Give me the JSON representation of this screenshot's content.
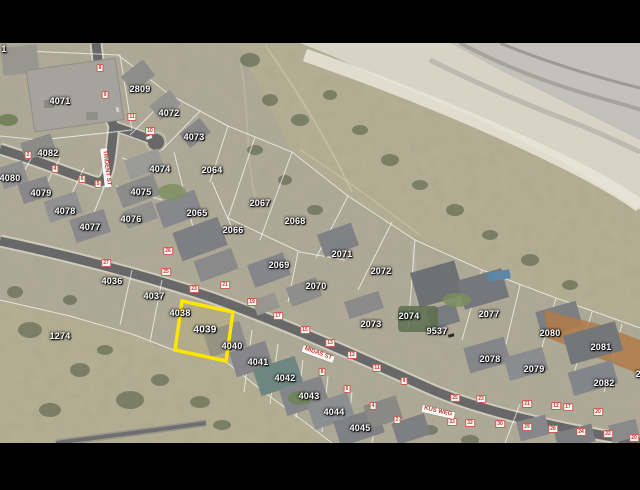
{
  "map": {
    "highlighted_parcel": "4039",
    "colors": {
      "highlight_outline": "#ffe600",
      "parcel_label_text": "#ffffff",
      "road_marker_text": "#c0392b",
      "road": "#686868",
      "dune_sand": "#b6ae94",
      "beach_sand": "#d7d3c5"
    },
    "street_labels": [
      {
        "text": "TRIDENT ST",
        "x": 106,
        "y": 168,
        "rot": 83
      },
      {
        "text": "MIDAS ST",
        "x": 318,
        "y": 354,
        "rot": 20
      },
      {
        "text": "KUS WEG",
        "x": 438,
        "y": 412,
        "rot": 13
      }
    ],
    "parcel_labels": [
      {
        "id": "1",
        "x": 4,
        "y": 49
      },
      {
        "id": "4071",
        "x": 60,
        "y": 101
      },
      {
        "id": "2809",
        "x": 140,
        "y": 89
      },
      {
        "id": "4072",
        "x": 169,
        "y": 113
      },
      {
        "id": "4073",
        "x": 194,
        "y": 137
      },
      {
        "id": "2064",
        "x": 212,
        "y": 170
      },
      {
        "id": "4074",
        "x": 160,
        "y": 169
      },
      {
        "id": "4075",
        "x": 141,
        "y": 192
      },
      {
        "id": "4076",
        "x": 131,
        "y": 219
      },
      {
        "id": "4082",
        "x": 48,
        "y": 153
      },
      {
        "id": "4080",
        "x": 10,
        "y": 178
      },
      {
        "id": "4079",
        "x": 41,
        "y": 193
      },
      {
        "id": "4078",
        "x": 65,
        "y": 211
      },
      {
        "id": "4077",
        "x": 90,
        "y": 227
      },
      {
        "id": "2065",
        "x": 197,
        "y": 213
      },
      {
        "id": "2066",
        "x": 233,
        "y": 230
      },
      {
        "id": "2067",
        "x": 260,
        "y": 203
      },
      {
        "id": "2068",
        "x": 295,
        "y": 221
      },
      {
        "id": "2069",
        "x": 279,
        "y": 265
      },
      {
        "id": "2070",
        "x": 316,
        "y": 286
      },
      {
        "id": "2071",
        "x": 342,
        "y": 254
      },
      {
        "id": "2072",
        "x": 381,
        "y": 271
      },
      {
        "id": "2073",
        "x": 371,
        "y": 324
      },
      {
        "id": "2074",
        "x": 409,
        "y": 316
      },
      {
        "id": "9537",
        "x": 437,
        "y": 331
      },
      {
        "id": "2077",
        "x": 489,
        "y": 314
      },
      {
        "id": "2078",
        "x": 490,
        "y": 359
      },
      {
        "id": "2079",
        "x": 534,
        "y": 369
      },
      {
        "id": "2080",
        "x": 550,
        "y": 333
      },
      {
        "id": "2081",
        "x": 601,
        "y": 347
      },
      {
        "id": "2082",
        "x": 604,
        "y": 383
      },
      {
        "id": "2083",
        "x": 646,
        "y": 374
      },
      {
        "id": "4036",
        "x": 112,
        "y": 281
      },
      {
        "id": "4037",
        "x": 154,
        "y": 296
      },
      {
        "id": "4038",
        "x": 180,
        "y": 313
      },
      {
        "id": "4039",
        "x": 205,
        "y": 330
      },
      {
        "id": "4040",
        "x": 232,
        "y": 346
      },
      {
        "id": "4041",
        "x": 258,
        "y": 362
      },
      {
        "id": "4042",
        "x": 285,
        "y": 378
      },
      {
        "id": "4043",
        "x": 309,
        "y": 396
      },
      {
        "id": "4044",
        "x": 334,
        "y": 412
      },
      {
        "id": "4045",
        "x": 360,
        "y": 428
      },
      {
        "id": "1274",
        "x": 60,
        "y": 336
      }
    ],
    "road_markers": [
      {
        "n": "8",
        "x": 100,
        "y": 68
      },
      {
        "n": "9",
        "x": 105,
        "y": 95
      },
      {
        "n": "11",
        "x": 132,
        "y": 117
      },
      {
        "n": "10",
        "x": 150,
        "y": 131
      },
      {
        "n": "2",
        "x": 28,
        "y": 155
      },
      {
        "n": "4",
        "x": 55,
        "y": 169
      },
      {
        "n": "6",
        "x": 82,
        "y": 179
      },
      {
        "n": "5",
        "x": 98,
        "y": 184
      },
      {
        "n": "27",
        "x": 106,
        "y": 263
      },
      {
        "n": "26",
        "x": 168,
        "y": 251
      },
      {
        "n": "25",
        "x": 166,
        "y": 272
      },
      {
        "n": "23",
        "x": 194,
        "y": 289
      },
      {
        "n": "21",
        "x": 225,
        "y": 285
      },
      {
        "n": "19",
        "x": 252,
        "y": 302
      },
      {
        "n": "17",
        "x": 278,
        "y": 316
      },
      {
        "n": "15",
        "x": 305,
        "y": 330
      },
      {
        "n": "13",
        "x": 330,
        "y": 343
      },
      {
        "n": "12",
        "x": 352,
        "y": 355
      },
      {
        "n": "11",
        "x": 377,
        "y": 368
      },
      {
        "n": "9",
        "x": 404,
        "y": 381
      },
      {
        "n": "8",
        "x": 322,
        "y": 372
      },
      {
        "n": "6",
        "x": 347,
        "y": 389
      },
      {
        "n": "4",
        "x": 373,
        "y": 406
      },
      {
        "n": "2",
        "x": 397,
        "y": 420
      },
      {
        "n": "25",
        "x": 455,
        "y": 398
      },
      {
        "n": "23",
        "x": 481,
        "y": 399
      },
      {
        "n": "21",
        "x": 527,
        "y": 404
      },
      {
        "n": "12",
        "x": 556,
        "y": 406
      },
      {
        "n": "17",
        "x": 568,
        "y": 407
      },
      {
        "n": "20",
        "x": 598,
        "y": 412
      },
      {
        "n": "33",
        "x": 452,
        "y": 422
      },
      {
        "n": "32",
        "x": 470,
        "y": 423
      },
      {
        "n": "30",
        "x": 500,
        "y": 424
      },
      {
        "n": "29",
        "x": 527,
        "y": 427
      },
      {
        "n": "26",
        "x": 553,
        "y": 429
      },
      {
        "n": "24",
        "x": 581,
        "y": 432
      },
      {
        "n": "22",
        "x": 608,
        "y": 434
      },
      {
        "n": "20",
        "x": 634,
        "y": 438
      }
    ]
  }
}
